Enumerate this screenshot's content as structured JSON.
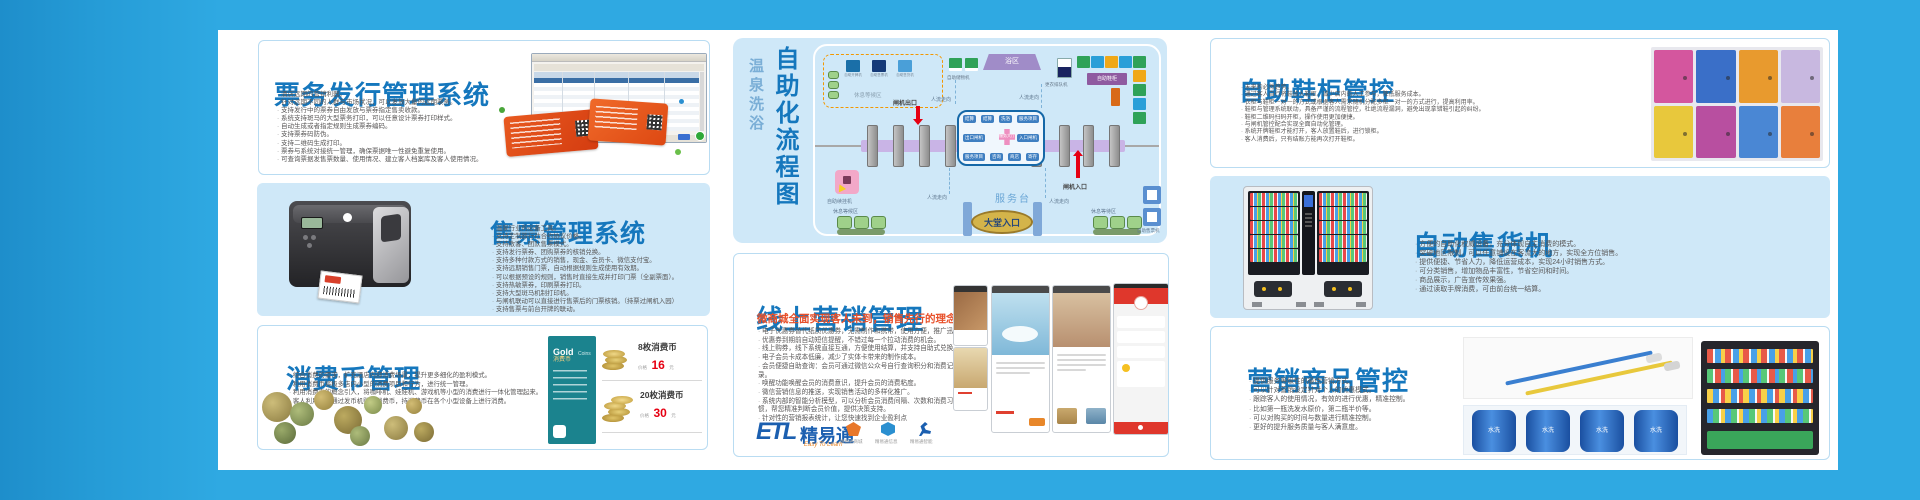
{
  "colors": {
    "frame_blue": "#2da7e0",
    "card_lightblue": "#cfe8f8",
    "title_blue": "#1577bd",
    "subtitle_red": "#e8502a",
    "price_red": "#e60012",
    "goldcard_teal": "#1b838e"
  },
  "ticket_issue": {
    "title": "票务发行管理系统",
    "bullets": [
      "酒店远期的营销利器。",
      "针对远期不同的人群与市场状况，可以发放大量的远期票务。",
      "支持发行中的票券自由发放与票券指定售卖收款。",
      "系统支持斑马的大型票务打印，可以任意设计票券打印样式。",
      "自动生成或者指定规则生成票券编码。",
      "支持票券码防伪。",
      "支持二维码生成打印。",
      "票券与系统对接统一管理，确保票据唯一性避免重复使用。",
      "可查询票据发售票数量、使用情况、建立客人档案库及客人使用情况。"
    ]
  },
  "ticket_sales": {
    "title": "售票管理系统",
    "bullets": [
      "温泉行业的必备工具。",
      "支持定制旅行社合约协议价格。",
      "支持散客、团队售票模式。",
      "支持发行票券、团购票券的核销兑换。",
      "支持多种付款方式的销售，现金、会员卡、微信支付宝。",
      "支持远期销售门票，自动根据规则生成使用有效期。",
      "可以根据预设的规则，销售时直接生成并打印门票（全副票面）。",
      "支持热敏票券，印刷票券打印。",
      "支持大型斑马机制打印机。",
      "与闸机联动可以直接进行售票后的门票核销。（持票过闸机入园）",
      "支持售票与前台开牌的联动。"
    ]
  },
  "coin": {
    "title": "消费币管理",
    "bullets": [
      "结合消费的需求，扩充酒店内部消费场景，提升更多细化的盈利模式。",
      "利用消费币将极多店内小型的消费项目和行为，进行统一管理。",
      "利用消费币的概念引入，将咖啡机、娃娃机、游戏机等小型的消费进行一体化管理起来。",
      "客人利用手牌通过发币机购买消费币，持消费币在各个小型设备上进行消费。"
    ],
    "gold_card": {
      "line1": "Gold",
      "line2": "Coins",
      "line3": "消费币"
    },
    "prices": [
      {
        "qty": "8枚消费币",
        "label": "价格",
        "value": "16",
        "unit": "元"
      },
      {
        "qty": "20枚消费币",
        "label": "价格",
        "value": "30",
        "unit": "元"
      }
    ]
  },
  "flow": {
    "title_main": "自助化流程图",
    "title_sub": "温泉洗浴",
    "labels": {
      "waiting_area": "休息等候区",
      "storage": "自助储物机",
      "bath": "浴区",
      "queue": "更衣排队机",
      "shoe_cabinet": "自助鞋柜",
      "gate_exit": "闸机出口",
      "gate_entrance": "闸机入口",
      "service_desk": "服务台",
      "lobby_entrance": "大堂入口",
      "flow_direction": "人流走向",
      "renew_machine": "自助续挂机",
      "rest_left": "休息等候区",
      "rest_right": "休息等待区",
      "ticket_machine": "自助售票机",
      "service_hall": "服务大厅"
    },
    "waiting_machines": [
      "自助开牌机",
      "自助售票机",
      "自助售货机"
    ],
    "service_items": [
      "结算",
      "结算",
      "洗浴",
      "服务项目",
      "出口闸机",
      "入口闸机",
      "服务项目",
      "咨询",
      "商店",
      "寄存"
    ]
  },
  "online_marketing": {
    "title": "线上营销管理",
    "subtitle": "微商城全面实现客人未到，销售先行的理念",
    "bullets": [
      "电子优惠券替代纸质优惠券，无需制作和携带，使用方便，推广迅速",
      "优惠券到期前自动短信提醒，不错过每一个拉动消费的机会。",
      "线上购券，线下系统直接互通，方便使用结算，并支持自助式兑换。",
      "电子会员卡成本低廉，减少了实体卡带来的制作成本。",
      "会员便捷自助查询：会员可通过微信公众号自行查询积分和消费记录。",
      "唤醒功能唤醒会员的消费意识，提升会员的消费粘度。",
      "微信营销信息的推送，实现销售活动的多样化推广。",
      "系统内部的智能分析模型，可以分析会员消费间隔、次数和消费习惯，帮您精准判断会员价值，提供决策支持。",
      "针对性的营销报表统计，让您快速找到企业盈利点"
    ],
    "logo": {
      "etl": "ETL",
      "brand": "精易通",
      "tagline": "Easy To Learn",
      "sub_brands": [
        "精易通商城",
        "精易通信息",
        "精易通智能"
      ]
    }
  },
  "shoe": {
    "title": "自助鞋柜管控",
    "bullets": [
      "未来的必然趋势。",
      "通过客人自行将鞋放入鞋柜，减少店内的人工参与，降低服务成本。",
      "衣柜与鞋柜一对一的方式或根据客人需求随机分配多柜一对一的方式进行，提高利用率。",
      "鞋柜与管理系统联动，具备严谨的流程管控，杜绝流程漏洞，避免出现拿错鞋引起的纠纷。",
      "鞋柜二维码扫码开柜，操作使用更加便捷。",
      "与闸机管控配合实现全面自动化管理。",
      "系统开牌鞋柜才能打开，客人放置鞋后，进行锁柜。",
      "客人消费后，只有结账方能再次打开鞋柜。"
    ]
  },
  "vending": {
    "title": "自动售货机",
    "bullets": [
      "方便的自助化权威设备，充分体现自主消费的模式。",
      "突破地区限制，可以任意铺设在客流大的地方，实现全方位销售。",
      "提供便捷、节省人力，降低运营成本，实现24小时销售方式。",
      "可分类销售，增加物品丰富性，节省空间和时间。",
      "商品展示，广告宣传效果强。",
      "通过读取手牌消费，可由前台统一结算。"
    ]
  },
  "merch": {
    "title": "营销商品管控",
    "towel_label": "水洗",
    "bullets": [
      "提供服务等级性的最佳营销方式。",
      "可以针对营销设定针对个人的优惠模式。",
      "跟踪客人的使用情况，有效的进行优惠，精准控制。",
      "比如第一瓶洗发水原价，第二瓶半价等。",
      "可以对购买的时间与数量进行精准控制。",
      "更好的提升服务质量与客人满意度。"
    ]
  }
}
